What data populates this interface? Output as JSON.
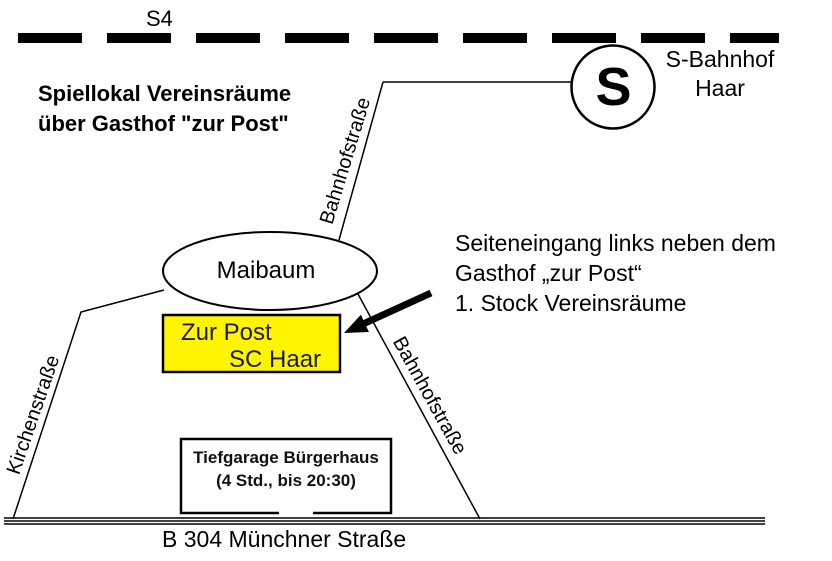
{
  "railway": {
    "label": "S4"
  },
  "title": {
    "line1": "Spiellokal Vereinsräume",
    "line2": "über Gasthof \"zur Post\""
  },
  "station": {
    "logo": "S",
    "name_line1": "S-Bahnhof",
    "name_line2": "Haar"
  },
  "streets": {
    "bahnhofstrasse_upper": "Bahnhofstraße",
    "bahnhofstrasse_lower": "Bahnhofstraße",
    "kirchenstrasse": "Kirchenstraße",
    "main_road": "B 304 Münchner Straße"
  },
  "landmarks": {
    "maibaum": "Maibaum",
    "venue": {
      "line1": "Zur Post",
      "line2": "SC Haar",
      "color": "#fff500"
    },
    "garage": {
      "line1": "Tiefgarage Bürgerhaus",
      "line2": "(4 Std., bis 20:30)"
    }
  },
  "note": {
    "line1": "Seiteneingang links neben dem",
    "line2": "Gasthof „zur Post“",
    "line3": "1. Stock Vereinsräume"
  },
  "colors": {
    "ink": "#000000",
    "background": "#ffffff"
  }
}
